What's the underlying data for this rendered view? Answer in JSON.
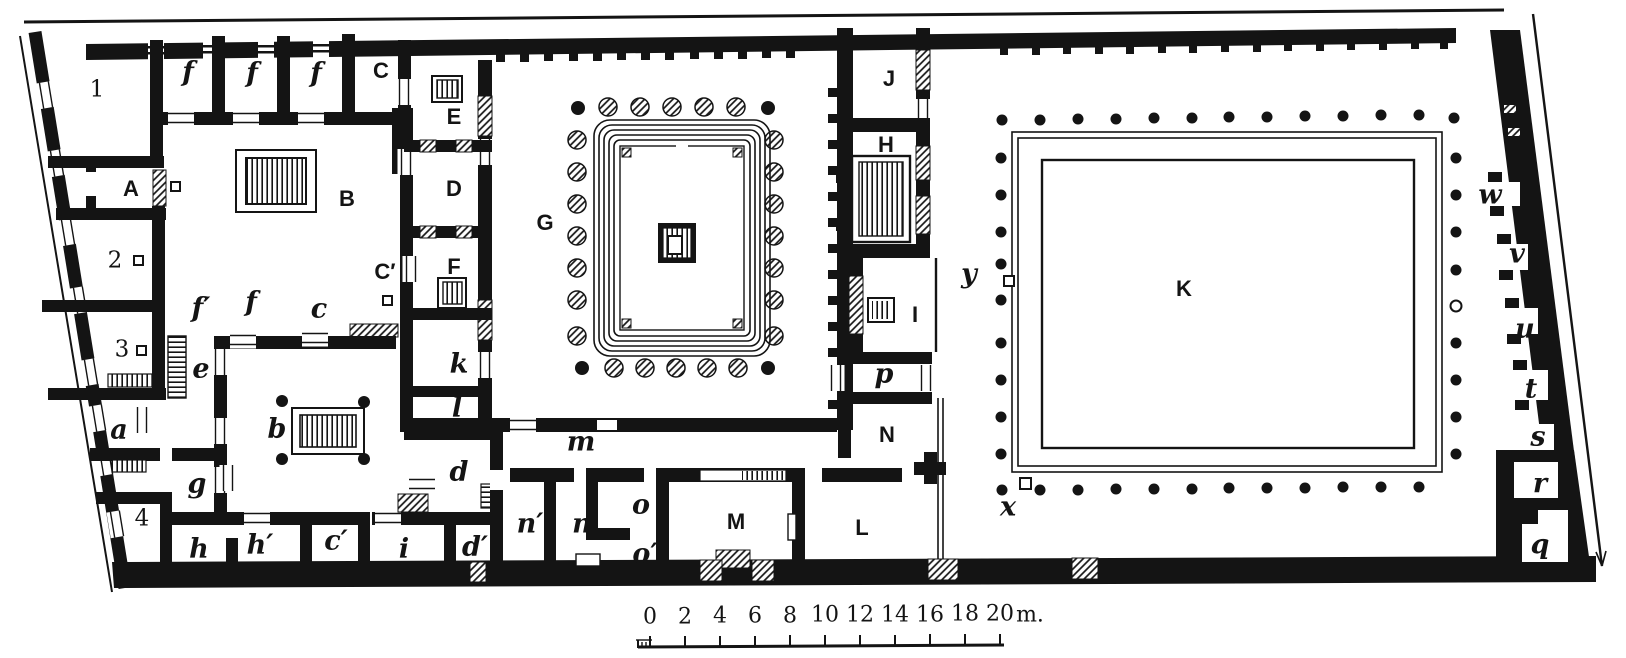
{
  "figure": {
    "type": "architectural floor plan (scanned engraving of a Roman house)",
    "ink_color": "#141414",
    "paper_color": "#ffffff"
  },
  "labels": {
    "n1": "1",
    "f1": "f",
    "f2": "f",
    "f3": "f",
    "C": "C",
    "A": "A",
    "B": "B",
    "n2": "2",
    "Cp": "C′",
    "n3": "3",
    "fp": "f′",
    "f4": "f",
    "c": "c",
    "e": "e",
    "a": "a",
    "b": "b",
    "g": "g",
    "n4": "4",
    "h": "h",
    "hp": "h′",
    "cp": "c′",
    "i": "i",
    "E": "E",
    "D": "D",
    "F": "F",
    "k": "k",
    "l": "l",
    "d": "d",
    "dp": "d′",
    "G": "G",
    "m": "m",
    "np": "n′",
    "n": "n",
    "o": "o",
    "op": "o′",
    "M": "M",
    "L": "L",
    "N": "N",
    "p": "p",
    "J": "J",
    "H": "H",
    "I": "I",
    "K": "K",
    "y": "y",
    "x": "x",
    "w": "w",
    "v": "v",
    "u": "u",
    "t": "t",
    "s": "s",
    "r": "r",
    "q": "q"
  },
  "scale_bar": {
    "ticks": [
      "0",
      "2",
      "4",
      "6",
      "8",
      "10",
      "12",
      "14",
      "16",
      "18",
      "20"
    ],
    "unit": "m."
  }
}
